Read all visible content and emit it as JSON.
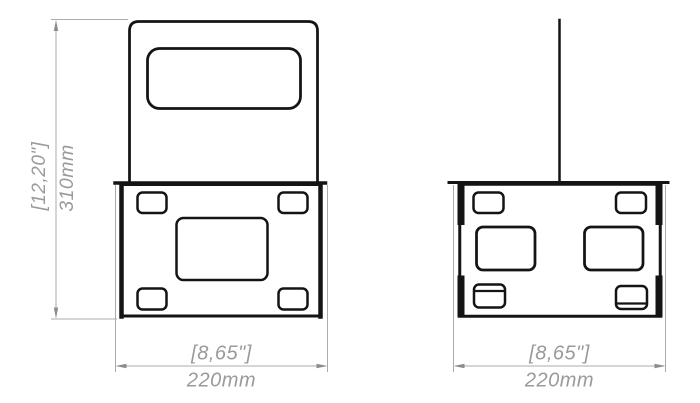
{
  "drawing": {
    "type": "technical-dimension-drawing",
    "background_color": "#ffffff",
    "part_line_color": "#141414",
    "dimension_color": "#9a9a9a",
    "views": [
      {
        "id": "front",
        "description": "front view: bracket with rounded-top panel, slot cutout, base plate with four corner holes and one center hole"
      },
      {
        "id": "side",
        "description": "side view: base plate with vertical pole, two top holes, two middle holes, two tabbed bottom holes"
      }
    ],
    "dimensions": {
      "height": {
        "secondary": "[12,20\"]",
        "primary": "310mm"
      },
      "front_width": {
        "secondary": "[8,65\"]",
        "primary": "220mm"
      },
      "side_width": {
        "secondary": "[8,65\"]",
        "primary": "220mm"
      }
    }
  }
}
